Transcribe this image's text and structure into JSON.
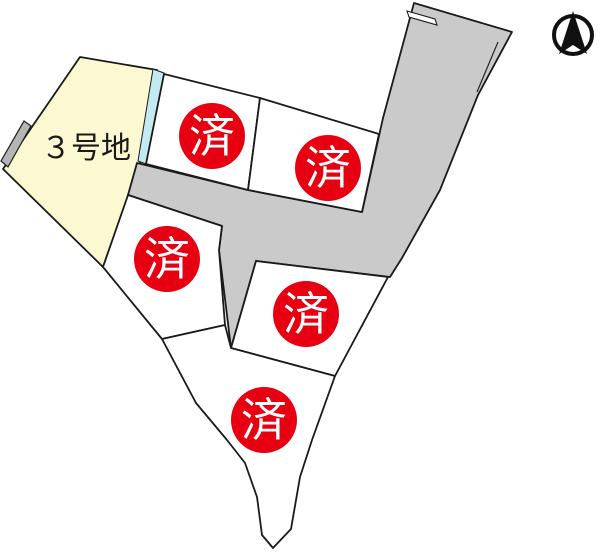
{
  "site_plan": {
    "available_lot": {
      "label": "３号地",
      "fill": "#fbf8d2"
    },
    "sold_markers": [
      {
        "label": "済"
      },
      {
        "label": "済"
      },
      {
        "label": "済"
      },
      {
        "label": "済"
      },
      {
        "label": "済"
      }
    ],
    "sold_marker_color": "#e60012",
    "sold_marker_text_color": "#ffffff",
    "road_color": "#cacaca",
    "waterway_color": "#c3e9f2",
    "wall_color": "#b5b5b5",
    "lot_fill_color": "#ffffff",
    "outline_color": "#1a1a1a",
    "compass_icon": "north-arrow"
  }
}
